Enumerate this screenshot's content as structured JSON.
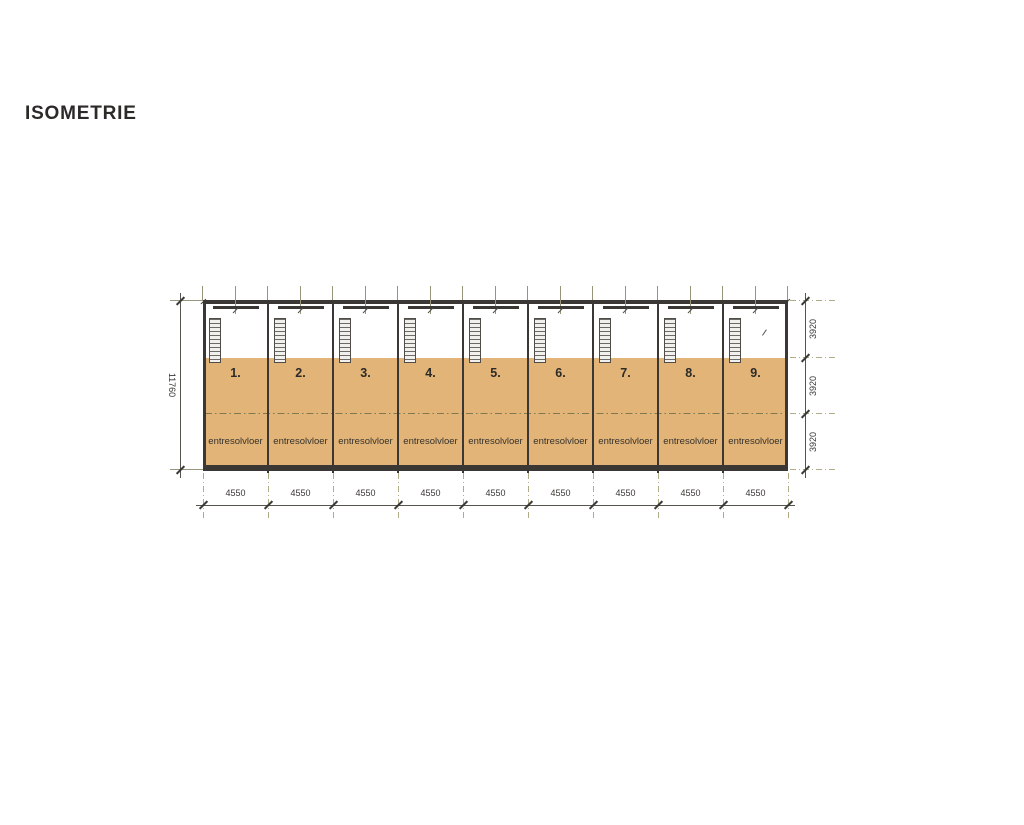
{
  "title": "ISOMETRIE",
  "drawing": {
    "units": [
      {
        "number": "1.",
        "floor_label": "entresolvloer"
      },
      {
        "number": "2.",
        "floor_label": "entresolvloer"
      },
      {
        "number": "3.",
        "floor_label": "entresolvloer"
      },
      {
        "number": "4.",
        "floor_label": "entresolvloer"
      },
      {
        "number": "5.",
        "floor_label": "entresolvloer"
      },
      {
        "number": "6.",
        "floor_label": "entresolvloer"
      },
      {
        "number": "7.",
        "floor_label": "entresolvloer"
      },
      {
        "number": "8.",
        "floor_label": "entresolvloer"
      },
      {
        "number": "9.",
        "floor_label": "entresolvloer"
      }
    ],
    "dimensions": {
      "total_height": "11760",
      "bay_widths": [
        "4550",
        "4550",
        "4550",
        "4550",
        "4550",
        "4550",
        "4550",
        "4550",
        "4550"
      ],
      "right_segments": [
        "3920",
        "3920",
        "3920"
      ]
    }
  },
  "colors": {
    "floor": "#e3b478",
    "wall": "#3a3734",
    "grid": "#b1ac87",
    "grid_dark": "#7e7950",
    "ink": "#2c2a27",
    "dim": "#57544e"
  }
}
